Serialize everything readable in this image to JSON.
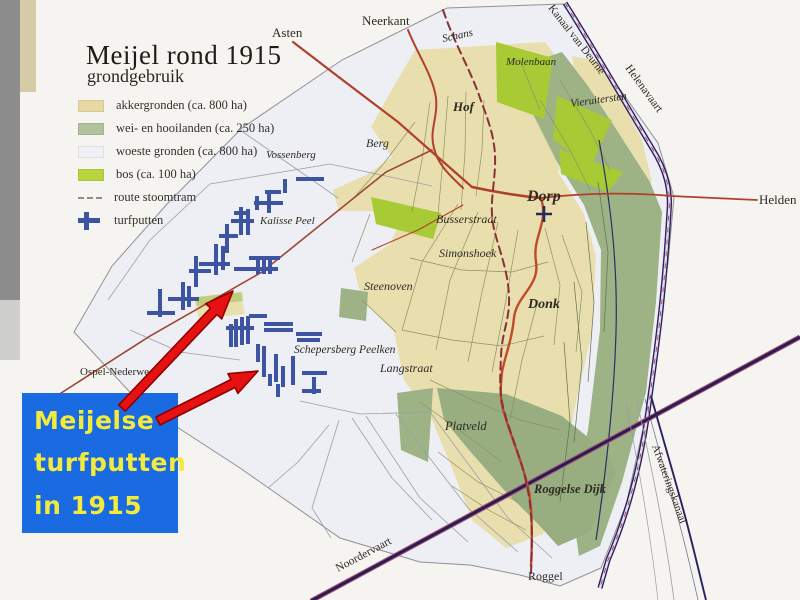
{
  "map": {
    "title": "Meijel rond 1915",
    "subtitle": "grondgebruik",
    "legend": [
      {
        "label": "akkergronden (ca. 800 ha)",
        "swatch": "fill",
        "color": "#e6d9a4"
      },
      {
        "label": "wei- en hooilanden (ca. 250 ha)",
        "swatch": "fill",
        "color": "#b2c29c"
      },
      {
        "label": "woeste gronden (ca. 800 ha)",
        "swatch": "fill",
        "color": "#f1f2f6"
      },
      {
        "label": "bos (ca. 100 ha)",
        "swatch": "fill",
        "color": "#b8d53e"
      },
      {
        "label": "route stoomtram",
        "swatch": "dash",
        "color": "#9a8a84"
      },
      {
        "label": "turfputten",
        "swatch": "cross",
        "color": "#3c54a2"
      }
    ],
    "colors": {
      "paper": "#f5f4f0",
      "woeste": "#edeff4",
      "akker": "#e9dfae",
      "wei": "#9db285",
      "bos": "#a8ca35",
      "turf": "#3c54a2",
      "road": "#b0402c",
      "tram": "#8a3038",
      "canal": "#2a2160"
    },
    "boundary": "447,8 563,4 612,78 658,143 674,197 668,263 658,333 650,398 626,505 601,568 560,586 520,575 470,565 420,562 340,538 240,468 140,403 74,332 112,266 168,203 242,128 342,60",
    "regions": [
      {
        "name": "akker-main",
        "fill": "#e9dfae",
        "pts": "415,50 545,42 572,78 548,94 542,120 570,150 558,172 584,214 596,256 592,332 576,402 562,472 543,534 506,548 472,520 452,468 431,418 404,380 394,332 362,300 354,268 390,244 398,226 371,211 339,211 333,190 368,174 392,157 371,127 391,91"
      },
      {
        "name": "akker-ne",
        "fill": "#e9dfae",
        "pts": "572,56 602,62 642,140 652,182 628,179 602,142 578,96"
      },
      {
        "name": "akker-ospel",
        "fill": "#e9dfae",
        "pts": "194,299 240,293 245,314 199,319"
      },
      {
        "name": "wei-east",
        "fill": "#9db285",
        "pts": "544,58 562,52 588,86 618,132 650,182 662,212 656,302 646,392 622,482 600,546 579,556 571,500 588,430 600,330 601,250 584,205 556,160 530,108"
      },
      {
        "name": "wei-south",
        "fill": "#98ae80",
        "pts": "437,388 506,394 562,416 606,452 616,472 590,532 558,546 538,524 504,490 469,450 444,420"
      },
      {
        "name": "wei-platveld",
        "fill": "#9db285",
        "pts": "397,393 433,388 428,462 401,450"
      },
      {
        "name": "wei-steenoven",
        "fill": "#9db285",
        "pts": "341,288 368,292 366,321 339,317"
      },
      {
        "name": "bos-1",
        "fill": "#a8ca35",
        "pts": "496,42 553,58 544,119 497,102"
      },
      {
        "name": "bos-2",
        "fill": "#a8ca35",
        "pts": "557,96 612,120 590,168 553,139"
      },
      {
        "name": "bos-3",
        "fill": "#a8ca35",
        "pts": "559,149 623,172 608,192 561,174"
      },
      {
        "name": "bos-4",
        "fill": "#a8ca35",
        "pts": "371,197 441,213 433,239 376,224"
      },
      {
        "name": "green-strip",
        "fill": "#b5c86a",
        "op": 0.8,
        "pts": "196,297 242,292 243,301 197,306"
      }
    ],
    "thin_lines": [
      "108,300 150,240 210,184 330,164 432,186",
      "329,425 298,462 268,488",
      "339,420 312,508 331,538",
      "352,418 392,478 432,520",
      "366,416 420,498 468,542",
      "396,414 468,508 518,552",
      "430,412 508,518 552,558",
      "300,401 360,414 432,412",
      "240,130 295,168 338,198",
      "130,330 180,352 240,360"
    ],
    "parcel_lines": [
      "448,96 443,160 438,214",
      "466,92 465,152 461,210",
      "430,102 422,160 412,212",
      "415,122 385,162 352,200",
      "484,100 482,150 476,196",
      "458,204 422,262 402,330",
      "478,212 450,280 436,350",
      "498,222 482,292 468,362",
      "518,230 506,300 492,372",
      "545,228 560,285 554,345",
      "562,235 582,292 576,352",
      "410,258 462,270 512,272 548,262",
      "402,330 452,340 502,346 544,336",
      "430,380 472,400 520,420 560,430",
      "420,402 462,432 502,462",
      "438,452 478,482 518,502",
      "452,486 492,512 526,530",
      "538,300 522,360 510,420",
      "370,214 352,262",
      "362,300 396,332",
      "560,80 590,130 610,170",
      "540,100 570,150 590,190",
      "520,60 540,110"
    ],
    "green_lines": [
      "598,182 608,252 604,332",
      "586,222 594,302 588,382",
      "574,282 582,362 574,442",
      "564,342 570,422 560,502"
    ],
    "canals": [
      {
        "name": "helenavaart-outer",
        "d": "M565,3 C590,42 622,98 652,148 C666,170 671,190 669,212 C665,282 659,332 650,396 C641,470 625,520 608,560 L600,588",
        "c": "#2a2160",
        "w": 5.2
      },
      {
        "name": "helenavaart-inner",
        "d": "M565,3 C590,42 622,98 652,148 C666,170 671,190 669,212 C665,282 659,332 650,396 C641,470 625,520 608,560 L600,588",
        "c": "#e9def0",
        "w": 2.4
      },
      {
        "name": "helenavaart-dash",
        "d": "M565,3 C590,42 622,98 652,148 C666,170 671,190 669,212 C665,282 659,332 650,396 C641,470 625,520 608,560 L600,588",
        "c": "#a23f4f",
        "w": 0.9,
        "dash": "5 7"
      },
      {
        "name": "stream",
        "d": "M599,140 C610,200 618,262 616,332 C614,402 606,472 596,540",
        "c": "#2a3060",
        "w": 1.2
      },
      {
        "name": "noordervaart-fringe",
        "d": "M311,601 L800,337",
        "c": "#a84f74",
        "w": 5
      },
      {
        "name": "noordervaart",
        "d": "M311,601 L800,337",
        "c": "#241d52",
        "w": 2.8
      },
      {
        "name": "afwateringskanaal",
        "d": "M651,396 C661,432 673,472 685,516 C693,546 700,576 706,600",
        "c": "#2a2160",
        "w": 1.9
      },
      {
        "name": "afwateringskanaal-2",
        "d": "M645,399 C655,436 667,478 679,522 C687,552 693,578 698,600",
        "c": "#2a2160",
        "w": 0.8,
        "op": 0.6
      },
      {
        "name": "afwat-gray-1",
        "d": "M637,401 C648,452 664,524 674,600",
        "c": "#9a9aa8",
        "w": 0.8
      },
      {
        "name": "afwat-gray-2",
        "d": "M626,404 C638,462 650,532 658,600",
        "c": "#9a9aa8",
        "w": 0.7
      }
    ],
    "roads": [
      {
        "name": "road-asten",
        "d": "M293,42 L340,78 L398,122 L432,152 L472,187",
        "c": "#b0402c",
        "w": 2.2
      },
      {
        "name": "road-neerkant",
        "d": "M408,30 C418,55 433,76 436,98 C438,118 429,131 434,148 C438,166 452,177 463,188",
        "c": "#b0402c",
        "w": 2
      },
      {
        "name": "road-dorp",
        "d": "M472,187 C495,192 520,196 541,198",
        "c": "#b0402c",
        "w": 2.6
      },
      {
        "name": "road-helden",
        "d": "M541,198 C590,192 640,193 671,196 L757,200",
        "c": "#b0402c",
        "w": 1.8
      },
      {
        "name": "road-roggel",
        "d": "M541,198 C549,224 532,236 536,262 C540,286 516,296 514,318 C512,340 505,356 502,372 C500,390 500,402 505,416 C512,440 524,466 529,492 C533,516 532,546 531,566",
        "c": "#c04a2a",
        "w": 2.4
      },
      {
        "name": "road-ospel",
        "d": "M58,395 L150,336 L262,272 L386,172 L432,150",
        "c": "#9c4632",
        "w": 1.6
      },
      {
        "name": "road-minor",
        "d": "M463,205 L418,230 L372,250",
        "c": "#b0402c",
        "w": 1.1
      },
      {
        "name": "tram-route",
        "d": "M443,10 C455,45 471,71 480,98 C490,125 496,141 495,166 C494,190 489,206 494,229 C500,253 508,271 509,296 C510,320 502,331 501,356 C500,381 499,391 504,411 C511,436 523,463 528,491 C533,516 532,549 531,573",
        "c": "#8a3038",
        "w": 2,
        "dash": "8 5"
      }
    ],
    "turfputten": [
      [
        265,
        190,
        16,
        4
      ],
      [
        283,
        179,
        4,
        14
      ],
      [
        296,
        177,
        28,
        4
      ],
      [
        254,
        201,
        29,
        4
      ],
      [
        267,
        191,
        4,
        22
      ],
      [
        255,
        196,
        4,
        14
      ],
      [
        234,
        211,
        16,
        4
      ],
      [
        231,
        219,
        23,
        4
      ],
      [
        239,
        207,
        4,
        28
      ],
      [
        246,
        209,
        4,
        26
      ],
      [
        219,
        234,
        19,
        4
      ],
      [
        225,
        224,
        4,
        29
      ],
      [
        199,
        262,
        31,
        4
      ],
      [
        214,
        244,
        4,
        31
      ],
      [
        221,
        246,
        4,
        24
      ],
      [
        189,
        269,
        22,
        4
      ],
      [
        194,
        256,
        4,
        31
      ],
      [
        249,
        256,
        31,
        4
      ],
      [
        256,
        256,
        4,
        18
      ],
      [
        262,
        256,
        4,
        18
      ],
      [
        268,
        256,
        4,
        18
      ],
      [
        234,
        267,
        44,
        4
      ],
      [
        168,
        297,
        31,
        4
      ],
      [
        181,
        282,
        4,
        28
      ],
      [
        187,
        286,
        4,
        21
      ],
      [
        147,
        311,
        28,
        4
      ],
      [
        158,
        289,
        4,
        28
      ],
      [
        226,
        326,
        28,
        4
      ],
      [
        229,
        324,
        4,
        23
      ],
      [
        234,
        319,
        4,
        28
      ],
      [
        240,
        317,
        4,
        28
      ],
      [
        246,
        316,
        4,
        28
      ],
      [
        249,
        314,
        18,
        4
      ],
      [
        264,
        322,
        29,
        4
      ],
      [
        264,
        328,
        29,
        4
      ],
      [
        296,
        332,
        26,
        4
      ],
      [
        297,
        338,
        23,
        4
      ],
      [
        256,
        344,
        4,
        18
      ],
      [
        262,
        346,
        4,
        31
      ],
      [
        274,
        354,
        4,
        28
      ],
      [
        281,
        366,
        4,
        21
      ],
      [
        291,
        356,
        4,
        29
      ],
      [
        302,
        371,
        25,
        4
      ],
      [
        312,
        377,
        4,
        17
      ],
      [
        302,
        389,
        19,
        4
      ],
      [
        276,
        384,
        4,
        13
      ],
      [
        268,
        374,
        4,
        12
      ]
    ],
    "church": {
      "x": 544,
      "y": 214
    },
    "labels": [
      {
        "t": "Asten",
        "x": 272,
        "y": 37,
        "s": "plain",
        "fs": 13
      },
      {
        "t": "Neerkant",
        "x": 362,
        "y": 25,
        "s": "plain",
        "fs": 13
      },
      {
        "t": "Schans",
        "x": 443,
        "y": 42,
        "s": "italic",
        "fs": 11,
        "r": -12
      },
      {
        "t": "Molenbaan",
        "x": 506,
        "y": 65,
        "s": "italic",
        "fs": 11
      },
      {
        "t": "Hof",
        "x": 453,
        "y": 111,
        "s": "bolditalic",
        "fs": 13
      },
      {
        "t": "Vieruitersten",
        "x": 571,
        "y": 107,
        "s": "italic",
        "fs": 11,
        "r": -8
      },
      {
        "t": "Vossenberg",
        "x": 266,
        "y": 158,
        "s": "italic",
        "fs": 11
      },
      {
        "t": "Berg",
        "x": 366,
        "y": 147,
        "s": "italic",
        "fs": 12
      },
      {
        "t": "Dorp",
        "x": 527,
        "y": 201,
        "s": "bolditalic",
        "fs": 16
      },
      {
        "t": "Helden",
        "x": 759,
        "y": 204,
        "s": "plain",
        "fs": 13
      },
      {
        "t": "Busserstraat",
        "x": 436,
        "y": 223,
        "s": "italic",
        "fs": 12
      },
      {
        "t": "Simonshoek",
        "x": 439,
        "y": 257,
        "s": "italic",
        "fs": 12
      },
      {
        "t": "Steenoven",
        "x": 364,
        "y": 290,
        "s": "italic",
        "fs": 12
      },
      {
        "t": "Donk",
        "x": 528,
        "y": 308,
        "s": "bolditalic",
        "fs": 14
      },
      {
        "t": "Kalisse Peel",
        "x": 260,
        "y": 224,
        "s": "italic",
        "fs": 11
      },
      {
        "t": "Schepersberg Peelken",
        "x": 294,
        "y": 353,
        "s": "italic",
        "fs": 11.5
      },
      {
        "t": "Ospel-Nederweert",
        "x": 80,
        "y": 375,
        "s": "plain",
        "fs": 11
      },
      {
        "t": "Langstraat",
        "x": 380,
        "y": 372,
        "s": "italic",
        "fs": 12
      },
      {
        "t": "Platveld",
        "x": 445,
        "y": 430,
        "s": "italic",
        "fs": 12.5
      },
      {
        "t": "Roggelse Dijk",
        "x": 534,
        "y": 493,
        "s": "bolditalic",
        "fs": 12.5
      },
      {
        "t": "Roggel",
        "x": 528,
        "y": 580,
        "s": "plain",
        "fs": 12
      },
      {
        "t": "Kanaal van Deurne",
        "x": 548,
        "y": 8,
        "s": "plain",
        "fs": 11,
        "r": 52
      },
      {
        "t": "Helenavaart",
        "x": 625,
        "y": 68,
        "s": "plain",
        "fs": 11.5,
        "r": 54
      },
      {
        "t": "Noordervaart",
        "x": 338,
        "y": 572,
        "s": "plain",
        "fs": 11.5,
        "r": -28
      },
      {
        "t": "Afwateringskanaal",
        "x": 652,
        "y": 446,
        "s": "plain",
        "fs": 11,
        "r": 70
      }
    ],
    "scan_edge": {
      "band": "#8d8d8d",
      "band2": "#b5b5b2",
      "strip": "#d5cba6"
    }
  },
  "callout": {
    "lines": [
      "Meijelse",
      "turfputten",
      "in 1915"
    ],
    "bg": "#1a6ae2",
    "text_color": "#f2ea3c"
  },
  "arrows": [
    {
      "x1": 122,
      "y1": 408,
      "x2": 233,
      "y2": 291,
      "fill": "#e61212",
      "outline": "#8f0000"
    },
    {
      "x1": 158,
      "y1": 421,
      "x2": 258,
      "y2": 371,
      "fill": "#e61212",
      "outline": "#8f0000"
    }
  ]
}
